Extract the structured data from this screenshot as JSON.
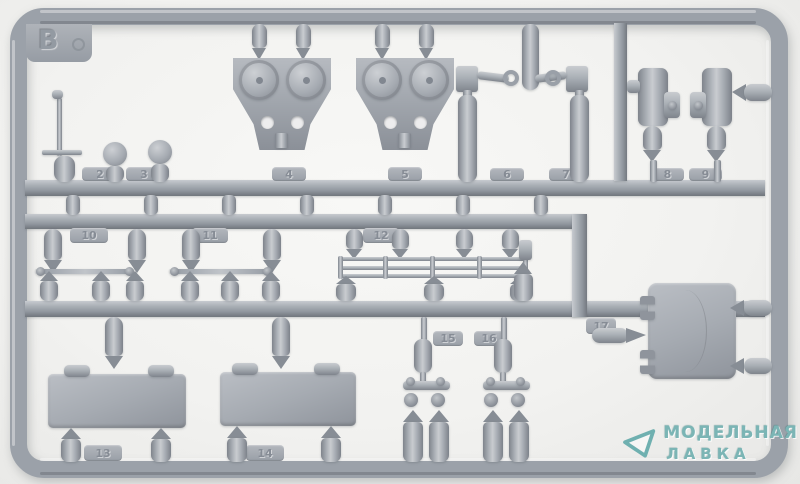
{
  "photo": {
    "subject": "gray plastic model-kit sprue frame, letter B",
    "sprue_letter": "B",
    "part_tags": [
      "2",
      "3",
      "4",
      "5",
      "6",
      "7",
      "8",
      "9",
      "10",
      "11",
      "12",
      "13",
      "14",
      "15",
      "16",
      "17"
    ]
  },
  "watermark": {
    "line1": "МОДЕЛЬНАЯ",
    "line2": "ЛАВКА"
  },
  "colors": {
    "plastic": "#9ba1a9",
    "background": "#f2f2f0",
    "watermark_teal": "#7bb5b5"
  }
}
